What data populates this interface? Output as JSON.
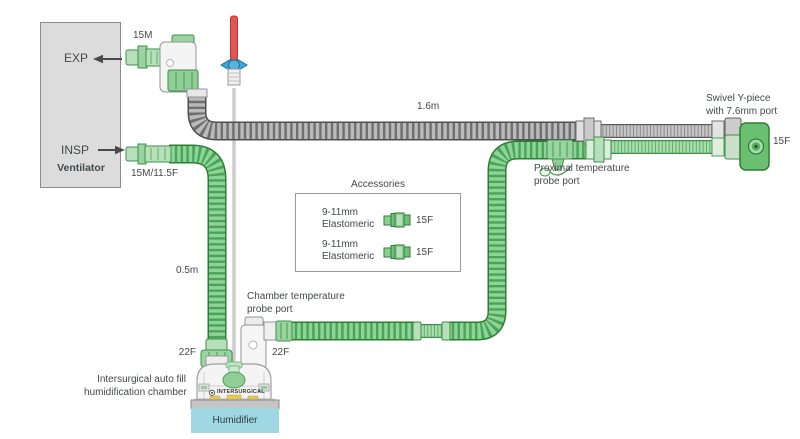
{
  "ventilator": {
    "label": "Ventilator",
    "exp_label": "EXP",
    "insp_label": "INSP",
    "exp_connector_size": "15M",
    "insp_connector_size": "15M/11.5F"
  },
  "circuit": {
    "expiratory_limb_length": "1.6m",
    "chamber_supply_length": "0.5m"
  },
  "ypiece": {
    "label_line1": "Swivel Y-piece",
    "label_line2": "with 7.6mm port",
    "connector_size": "15F"
  },
  "proximal_probe": {
    "label_line1": "Proximal temperature",
    "label_line2": "probe port"
  },
  "chamber_probe": {
    "label_line1": "Chamber temperature",
    "label_line2": "probe port"
  },
  "chamber": {
    "inlet_size": "22F",
    "outlet_size": "22F",
    "caption_line1": "Intersurgical auto fill",
    "caption_line2": "humidification chamber",
    "brand": "INTERSURGICAL"
  },
  "humidifier": {
    "label": "Humidifier"
  },
  "accessories": {
    "title": "Accessories",
    "items": [
      {
        "desc_line1": "9-11mm",
        "desc_line2": "Elastomeric",
        "size": "15F"
      },
      {
        "desc_line1": "9-11mm",
        "desc_line2": "Elastomeric",
        "size": "15F"
      }
    ]
  },
  "colors": {
    "tube_green": "#6abf71",
    "tube_gray": "#b9b9b9",
    "humidifier_blue": "#9fd8e2",
    "probe_red": "#e25550",
    "probe_wings_blue": "#3fa7dc",
    "ventilator_gray": "#dcdcdc"
  }
}
